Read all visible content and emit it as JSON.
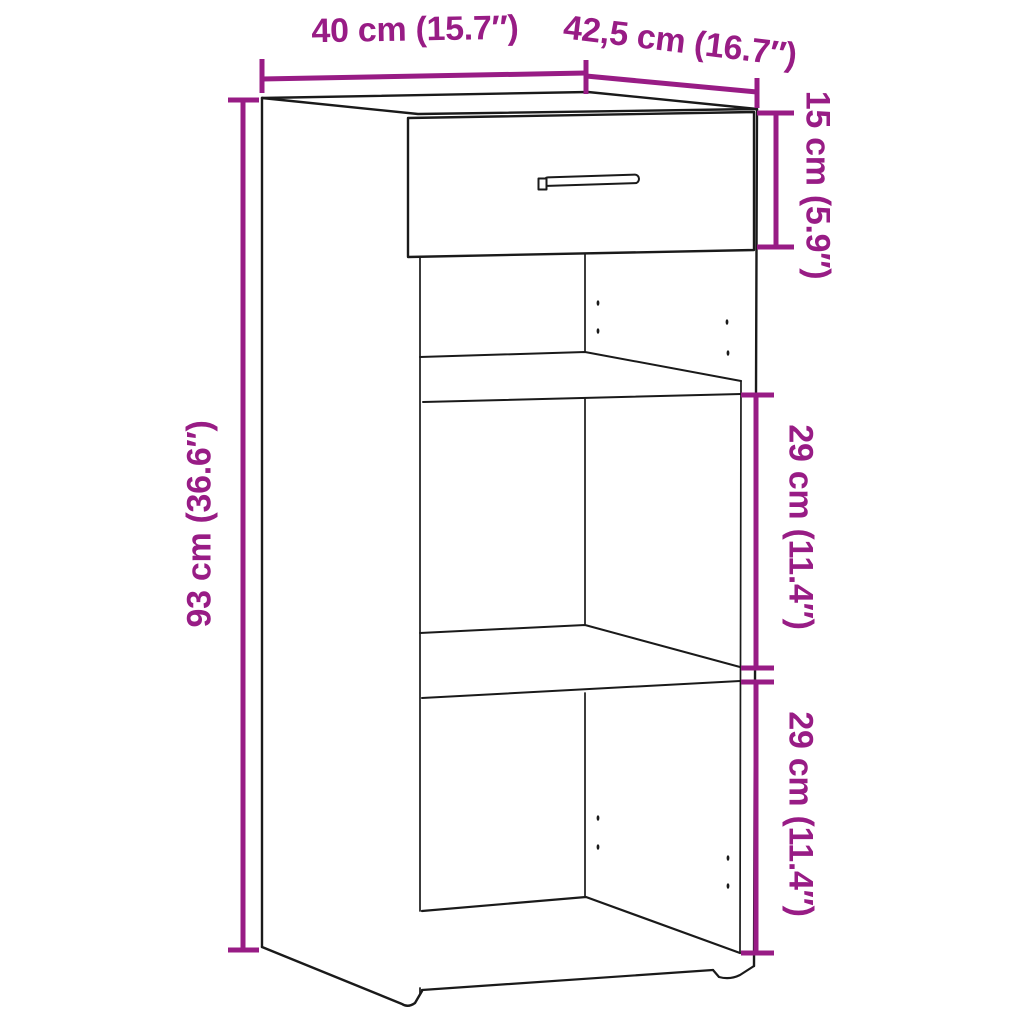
{
  "diagram": {
    "title": "Sideboard cabinet dimension diagram",
    "accent_color": "#981C85",
    "line_color": "#1A1A1A",
    "background_color": "#FFFFFF",
    "labels": {
      "width": "40 cm (15.7″)",
      "depth": "42,5 cm (16.7″)",
      "drawer_height": "15 cm (5.9″)",
      "total_height": "93 cm (36.6″)",
      "upper_compartment": "29 cm (11.4″)",
      "lower_compartment": "29 cm (11.4″)"
    },
    "values": {
      "width_cm": 40,
      "width_in": 15.7,
      "depth_cm": 42.5,
      "depth_in": 16.7,
      "drawer_height_cm": 15,
      "drawer_height_in": 5.9,
      "total_height_cm": 93,
      "total_height_in": 36.6,
      "upper_compartment_cm": 29,
      "upper_compartment_in": 11.4,
      "lower_compartment_cm": 29,
      "lower_compartment_in": 11.4
    }
  }
}
